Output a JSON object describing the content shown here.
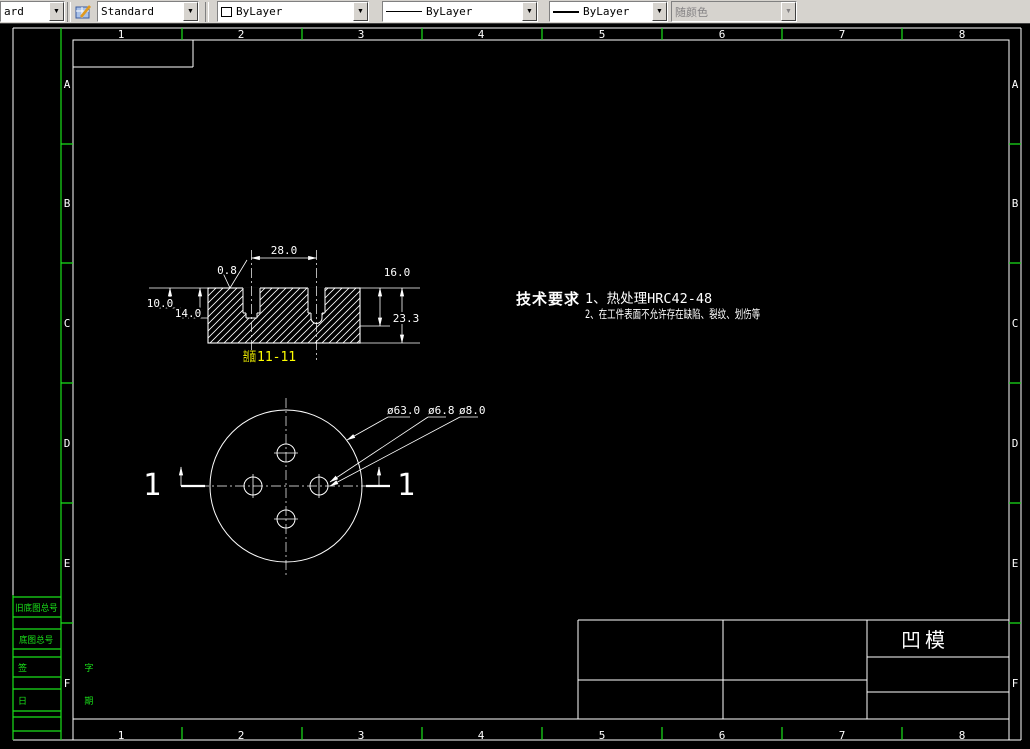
{
  "toolbar": {
    "combo_clipped": {
      "value": "ard"
    },
    "text_style": {
      "value": "Standard"
    },
    "color": {
      "value": "ByLayer"
    },
    "linetype": {
      "value": "ByLayer"
    },
    "lineweight": {
      "value": "ByLayer"
    },
    "plot_style": {
      "value": "随颜色"
    },
    "arrow_glyph": "▼"
  },
  "frame": {
    "top_numbers": [
      "1",
      "2",
      "3",
      "4",
      "5",
      "6",
      "7",
      "8"
    ],
    "bottom_numbers": [
      "1",
      "2",
      "3",
      "4",
      "5",
      "6",
      "7",
      "8"
    ],
    "left_letters": [
      "A",
      "B",
      "C",
      "D",
      "E",
      "F"
    ],
    "right_letters": [
      "A",
      "B",
      "C",
      "D",
      "E",
      "F"
    ]
  },
  "margin_block": {
    "row1": "旧底图总号",
    "row2": "底图总号",
    "row3": "签 字",
    "row4": "日 期"
  },
  "drawing": {
    "section": {
      "label_prefix": "剖面",
      "label": "11-11",
      "dim_width": "28.0",
      "dim_roughness": "0.8",
      "dim_right_top": "16.0",
      "dim_right_total": "23.3",
      "dim_left_top": "10.0",
      "dim_left_mid": "14.0"
    },
    "plan": {
      "marker_left": "1",
      "marker_right": "1",
      "dia_outer": "ø63.0",
      "dia_small": "ø6.8",
      "dia_large": "ø8.0"
    },
    "tech_req": {
      "title": "技术要求",
      "line1": "1、热处理HRC42-48",
      "line2": "2、在工件表面不允许存在缺陷、裂纹、划伤等"
    },
    "title_block": {
      "part_name": "凹模"
    }
  },
  "colors": {
    "canvas": "#000000",
    "line_white": "#ffffff",
    "tick_green": "#19e119",
    "label_yellow": "#ffff00",
    "toolbar_bg": "#d6d3ce"
  }
}
